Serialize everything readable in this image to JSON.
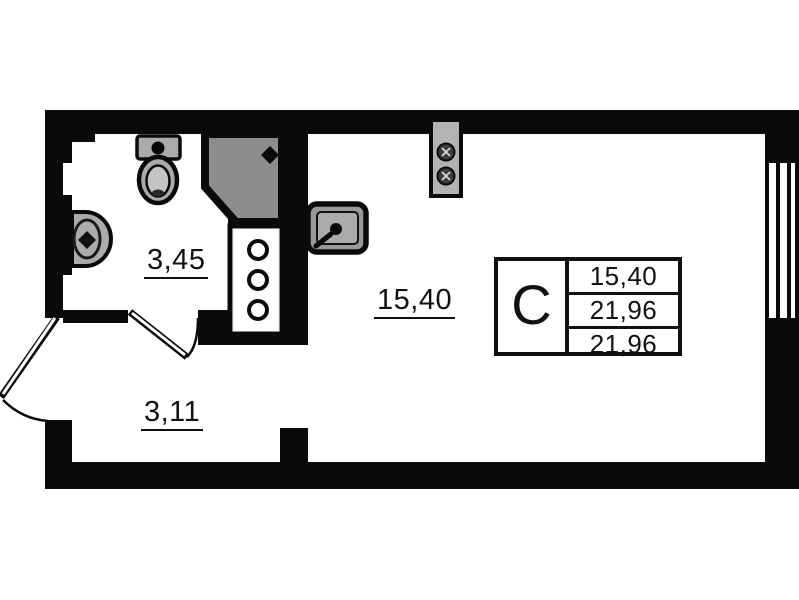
{
  "rooms": {
    "bathroom": {
      "area": "3,45"
    },
    "hallway": {
      "area": "3,11"
    },
    "living": {
      "area": "15,40"
    }
  },
  "info_table": {
    "type": "С",
    "values": [
      "15,40",
      "21,96",
      "21,96"
    ]
  },
  "fixtures": {
    "shower": "shower-tray-icon",
    "toilet": "toilet-icon",
    "wash_basin": "wash-basin-icon",
    "riser_cabinet": "riser-cabinet-icon",
    "kitchen_sink": "kitchen-sink-icon",
    "stove": "stove-icon",
    "entrance_door": "door-swing-icon",
    "bathroom_door": "door-swing-icon",
    "window": "window-icon"
  },
  "colors": {
    "wall": "#0a0a0a",
    "background": "#ffffff",
    "shower_fill": "#8d8d8d",
    "fixture_fill": "#ababab"
  }
}
